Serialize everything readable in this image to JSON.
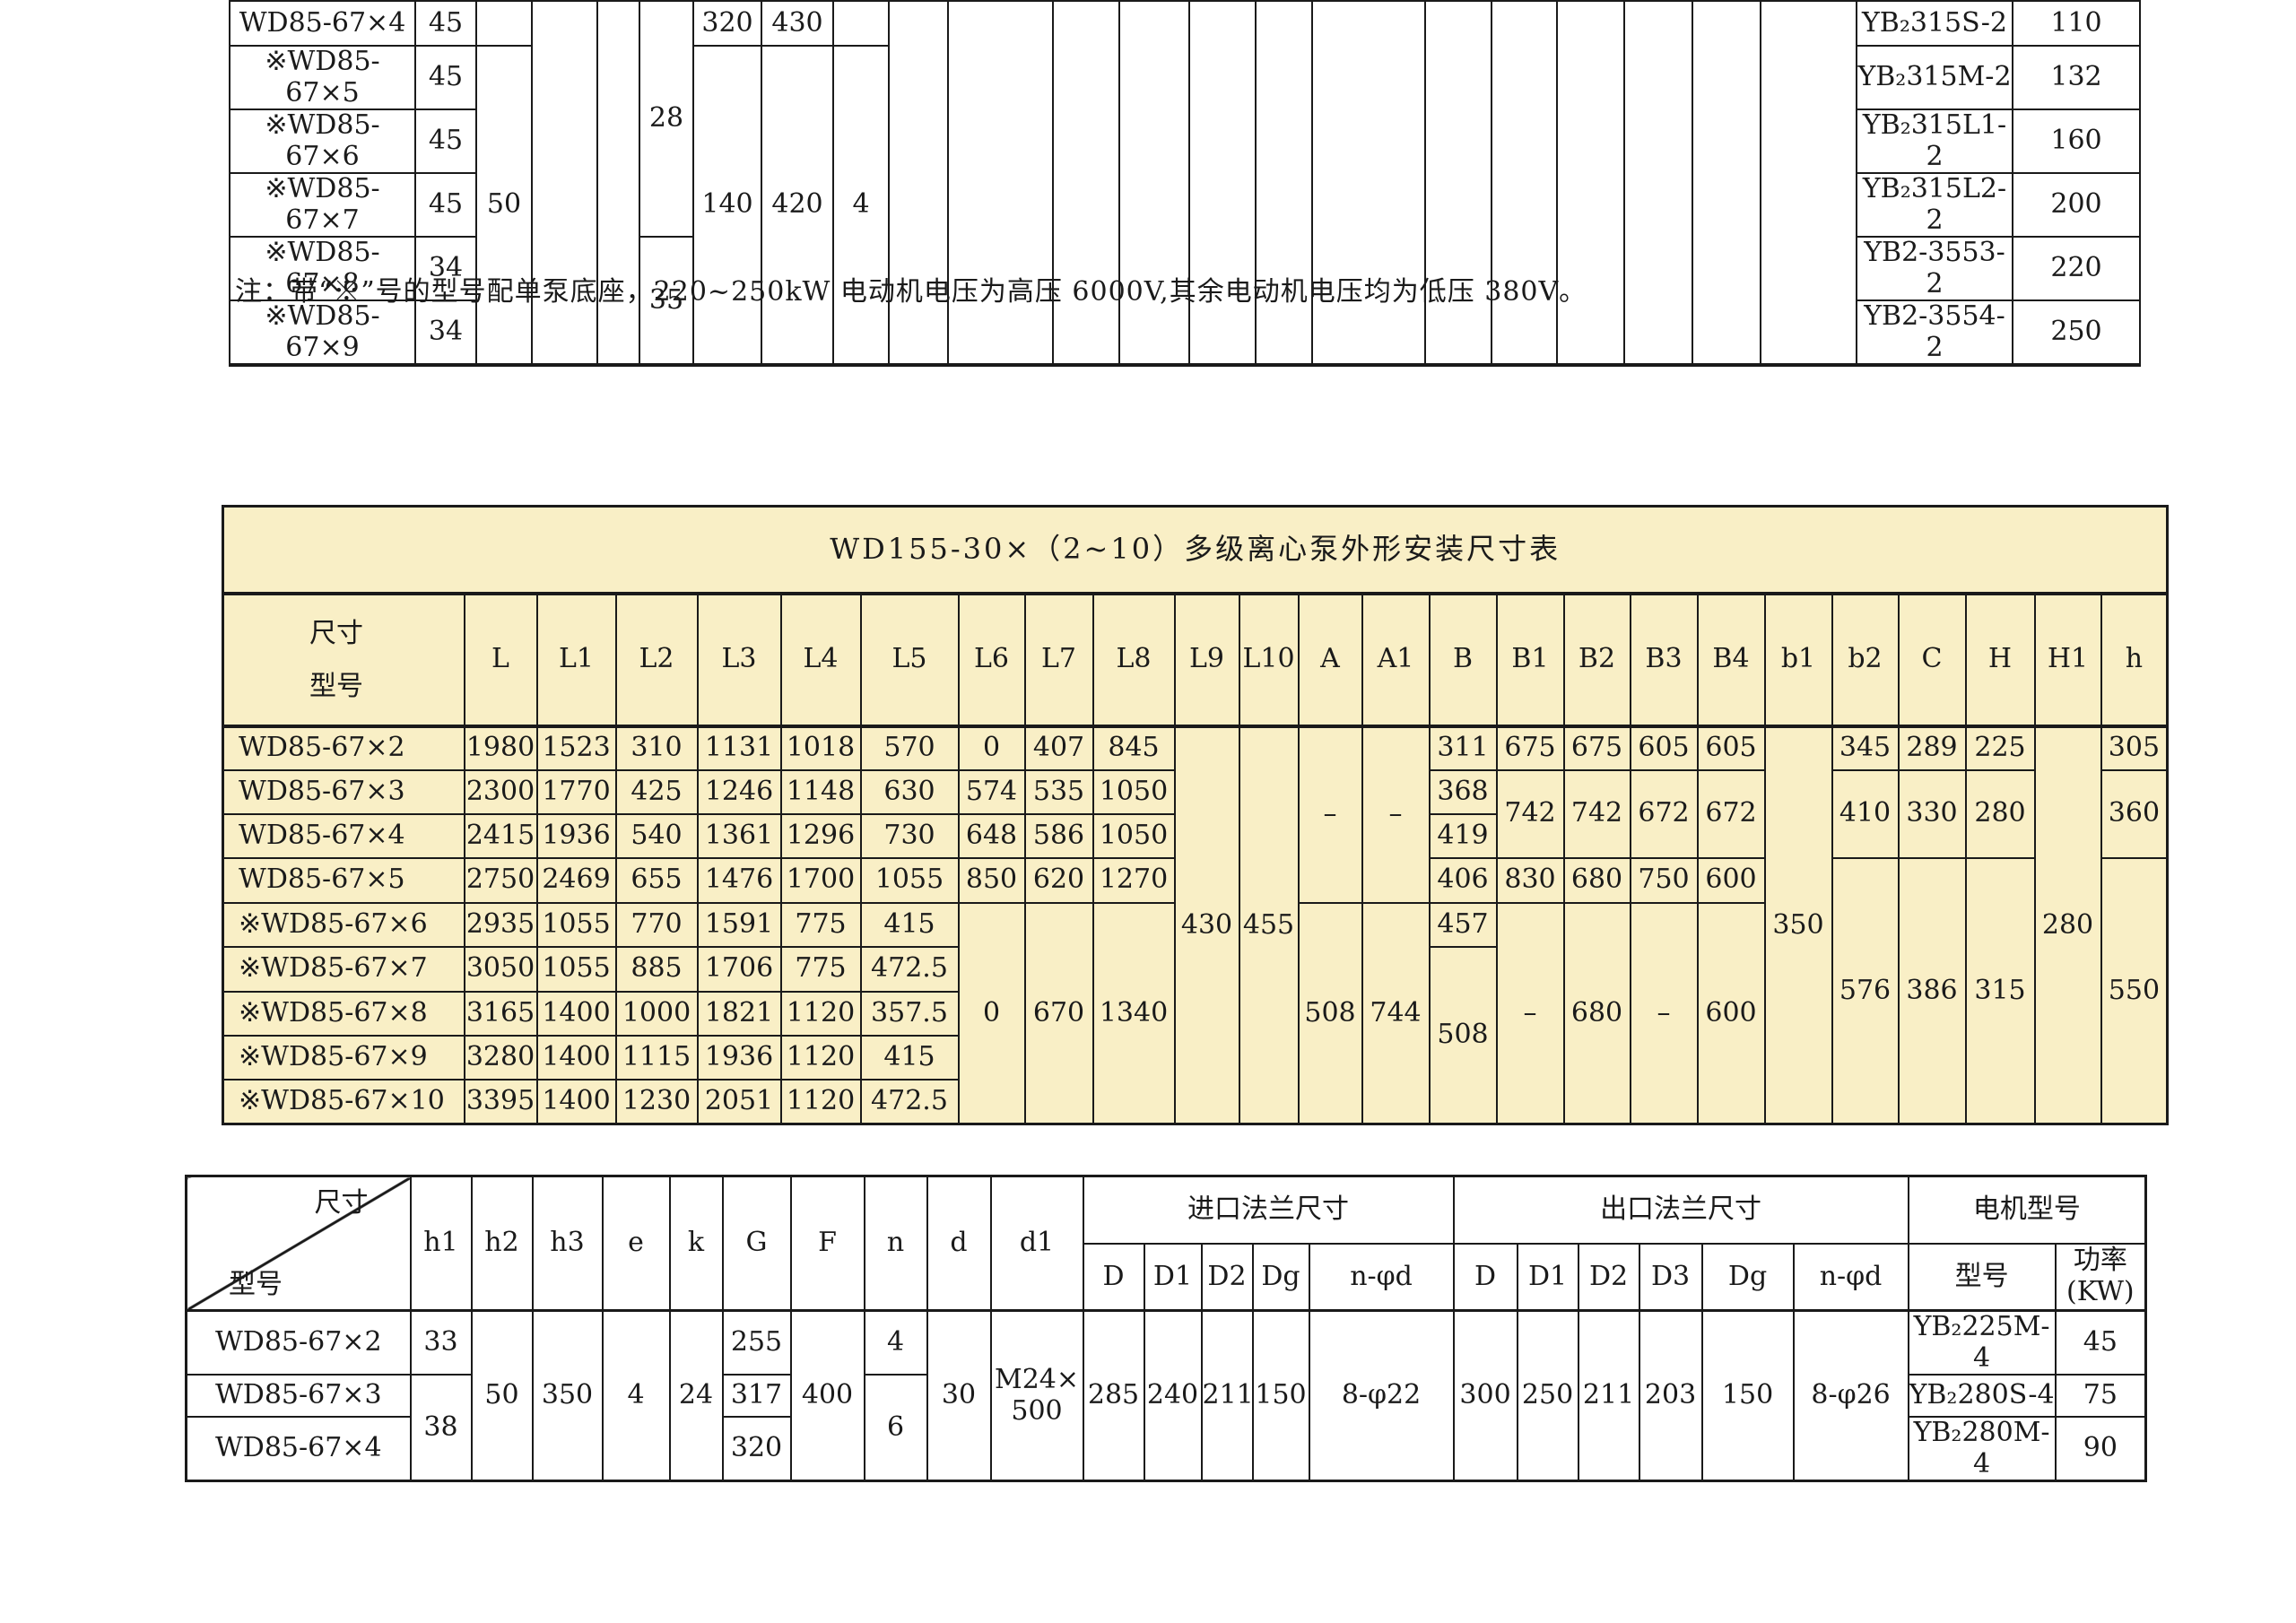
{
  "note": "注：带“※”号的型号配单泵底座，220~250kW 电动机电压为高压 6000V,其余电动机电压均为低压 380V。",
  "colors": {
    "table_bg_yellow": "#f9efc6",
    "border": "#1a1a1a",
    "text": "#1a1a1a",
    "page_bg": "#ffffff"
  },
  "top_table": {
    "rows": [
      {
        "cls": "data",
        "cells": [
          "WD85-67×4",
          "45",
          "",
          {
            "t": "",
            "rs": 6
          },
          {
            "t": "",
            "rs": 6
          },
          {
            "t": "28",
            "rs": 4
          },
          "320",
          "430",
          "",
          {
            "t": "",
            "rs": 6
          },
          {
            "t": "",
            "rs": 6
          },
          {
            "t": "",
            "rs": 6
          },
          {
            "t": "",
            "rs": 6
          },
          {
            "t": "",
            "rs": 6
          },
          {
            "t": "",
            "rs": 6
          },
          {
            "t": "",
            "rs": 6
          },
          {
            "t": "",
            "rs": 6
          },
          {
            "t": "",
            "rs": 6
          },
          {
            "t": "",
            "rs": 6
          },
          {
            "t": "",
            "rs": 6
          },
          {
            "t": "",
            "rs": 6
          },
          {
            "t": "",
            "rs": 6
          },
          "YB₂315S-2",
          "110"
        ]
      },
      {
        "cls": "data",
        "cells": [
          "※WD85-67×5",
          "45",
          {
            "t": "50",
            "rs": 5
          },
          {
            "t": "140",
            "rs": 5
          },
          {
            "t": "420",
            "rs": 5
          },
          {
            "t": "4",
            "rs": 5
          },
          "YB₂315M-2",
          "132"
        ]
      },
      {
        "cls": "data",
        "cells": [
          "※WD85-67×6",
          "45",
          "YB₂315L1-2",
          "160"
        ]
      },
      {
        "cls": "data",
        "cells": [
          "※WD85-67×7",
          "45",
          "YB₂315L2-2",
          "200"
        ]
      },
      {
        "cls": "data",
        "cells": [
          "※WD85-67×8",
          "34",
          {
            "t": "35",
            "rs": 2
          },
          "YB2-3553-2",
          "220"
        ]
      },
      {
        "cls": "data",
        "cells": [
          "※WD85-67×9",
          "34",
          "YB2-3554-2",
          "250"
        ]
      }
    ]
  },
  "middle_table": {
    "title": "WD155-30×（2~10）多级离心泵外形安装尺寸表",
    "corner": {
      "top": "尺寸",
      "bottom": "型号"
    },
    "rows": [
      {
        "cls": "title",
        "cells": [
          {
            "t": "WD155-30×（2~10）多级离心泵外形安装尺寸表",
            "cs": 25,
            "n": "table-title"
          }
        ]
      },
      {
        "cls": "head",
        "cells": [
          {
            "t": "尺寸\n型号",
            "cls": "stack",
            "n": "corner-cell"
          },
          "L",
          "L1",
          "L2",
          "L3",
          "L4",
          "L5",
          "L6",
          "L7",
          "L8",
          "L9",
          "L10",
          "A",
          "A1",
          "B",
          "B1",
          "B2",
          "B3",
          "B4",
          "b1",
          "b2",
          "C",
          "H",
          "H1",
          "h"
        ]
      },
      {
        "cls": "data",
        "cells": [
          "WD85-67×2",
          "1980",
          "1523",
          "310",
          "1131",
          "1018",
          "570",
          "0",
          "407",
          "845",
          {
            "t": "430",
            "rs": 9
          },
          {
            "t": "455",
            "rs": 9
          },
          {
            "t": "–",
            "rs": 4
          },
          {
            "t": "–",
            "rs": 4
          },
          "311",
          "675",
          "675",
          "605",
          "605",
          {
            "t": "350",
            "rs": 9
          },
          "345",
          "289",
          "225",
          {
            "t": "280",
            "rs": 9
          },
          "305"
        ]
      },
      {
        "cls": "data",
        "cells": [
          "WD85-67×3",
          "2300",
          "1770",
          "425",
          "1246",
          "1148",
          "630",
          "574",
          "535",
          "1050",
          "368",
          {
            "t": "742",
            "rs": 2
          },
          {
            "t": "742",
            "rs": 2
          },
          {
            "t": "672",
            "rs": 2
          },
          {
            "t": "672",
            "rs": 2
          },
          {
            "t": "410",
            "rs": 2
          },
          {
            "t": "330",
            "rs": 2
          },
          {
            "t": "280",
            "rs": 2
          },
          {
            "t": "360",
            "rs": 2
          }
        ]
      },
      {
        "cls": "data",
        "cells": [
          "WD85-67×4",
          "2415",
          "1936",
          "540",
          "1361",
          "1296",
          "730",
          "648",
          "586",
          "1050",
          "419"
        ]
      },
      {
        "cls": "data",
        "cells": [
          "WD85-67×5",
          "2750",
          "2469",
          "655",
          "1476",
          "1700",
          "1055",
          "850",
          "620",
          "1270",
          "406",
          "830",
          "680",
          "750",
          "600",
          {
            "t": "576",
            "rs": 6
          },
          {
            "t": "386",
            "rs": 6
          },
          {
            "t": "315",
            "rs": 6
          },
          {
            "t": "550",
            "rs": 6
          }
        ]
      },
      {
        "cls": "data",
        "cells": [
          "※WD85-67×6",
          "2935",
          "1055",
          "770",
          "1591",
          "775",
          "415",
          {
            "t": "0",
            "rs": 5
          },
          {
            "t": "670",
            "rs": 5
          },
          {
            "t": "1340",
            "rs": 5
          },
          {
            "t": "508",
            "rs": 5
          },
          {
            "t": "744",
            "rs": 5
          },
          "457",
          {
            "t": "–",
            "rs": 5
          },
          {
            "t": "680",
            "rs": 5
          },
          {
            "t": "–",
            "rs": 5
          },
          {
            "t": "600",
            "rs": 5
          }
        ]
      },
      {
        "cls": "data",
        "cells": [
          "※WD85-67×7",
          "3050",
          "1055",
          "885",
          "1706",
          "775",
          "472.5",
          {
            "t": "508",
            "rs": 4
          }
        ]
      },
      {
        "cls": "data",
        "cells": [
          "※WD85-67×8",
          "3165",
          "1400",
          "1000",
          "1821",
          "1120",
          "357.5"
        ]
      },
      {
        "cls": "data",
        "cells": [
          "※WD85-67×9",
          "3280",
          "1400",
          "1115",
          "1936",
          "1120",
          "415"
        ]
      },
      {
        "cls": "data",
        "cells": [
          "※WD85-67×10",
          "3395",
          "1400",
          "1230",
          "2051",
          "1120",
          "472.5"
        ]
      }
    ]
  },
  "bottom_table": {
    "groups": {
      "inlet": "进口法兰尺寸",
      "outlet": "出口法兰尺寸",
      "motor": "电机型号"
    },
    "rows": [
      {
        "cls": "head",
        "cells": [
          {
            "t": "尺寸\n型号",
            "cls": "diag",
            "rs": 2,
            "n": "corner-cell"
          },
          {
            "t": "h1",
            "rs": 2
          },
          {
            "t": "h2",
            "rs": 2
          },
          {
            "t": "h3",
            "rs": 2
          },
          {
            "t": "e",
            "rs": 2
          },
          {
            "t": "k",
            "rs": 2
          },
          {
            "t": "G",
            "rs": 2
          },
          {
            "t": "F",
            "rs": 2
          },
          {
            "t": "n",
            "rs": 2
          },
          {
            "t": "d",
            "rs": 2
          },
          {
            "t": "d1",
            "rs": 2
          },
          {
            "t": "进口法兰尺寸",
            "cs": 5
          },
          {
            "t": "出口法兰尺寸",
            "cs": 6
          },
          {
            "t": "电机型号",
            "cs": 2
          }
        ]
      },
      {
        "cls": "head sub",
        "cells": [
          "D",
          "D1",
          "D2",
          "Dg",
          "n-φd",
          "D",
          "D1",
          "D2",
          "D3",
          "Dg",
          "n-φd",
          "型号",
          {
            "t": "功率\n(KW)",
            "cls": "two"
          }
        ]
      },
      {
        "cls": "data",
        "cells": [
          "WD85-67×2",
          "33",
          {
            "t": "50",
            "rs": 3
          },
          {
            "t": "350",
            "rs": 3
          },
          {
            "t": "4",
            "rs": 3
          },
          {
            "t": "24",
            "rs": 3
          },
          "255",
          {
            "t": "400",
            "rs": 3
          },
          "4",
          {
            "t": "30",
            "rs": 3
          },
          {
            "t": "M24×\n500",
            "rs": 3,
            "cls": "two"
          },
          {
            "t": "285",
            "rs": 3
          },
          {
            "t": "240",
            "rs": 3
          },
          {
            "t": "211",
            "rs": 3
          },
          {
            "t": "150",
            "rs": 3
          },
          {
            "t": "8-φ22",
            "rs": 3
          },
          {
            "t": "300",
            "rs": 3
          },
          {
            "t": "250",
            "rs": 3
          },
          {
            "t": "211",
            "rs": 3
          },
          {
            "t": "203",
            "rs": 3
          },
          {
            "t": "150",
            "rs": 3
          },
          {
            "t": "8-φ26",
            "rs": 3
          },
          "YB₂225M-4",
          "45"
        ]
      },
      {
        "cls": "data",
        "cells": [
          "WD85-67×3",
          {
            "t": "38",
            "rs": 2
          },
          "317",
          {
            "t": "6",
            "rs": 2
          },
          "YB₂280S-4",
          "75"
        ]
      },
      {
        "cls": "data",
        "cells": [
          "WD85-67×4",
          "320",
          "YB₂280M-4",
          "90"
        ]
      }
    ]
  }
}
